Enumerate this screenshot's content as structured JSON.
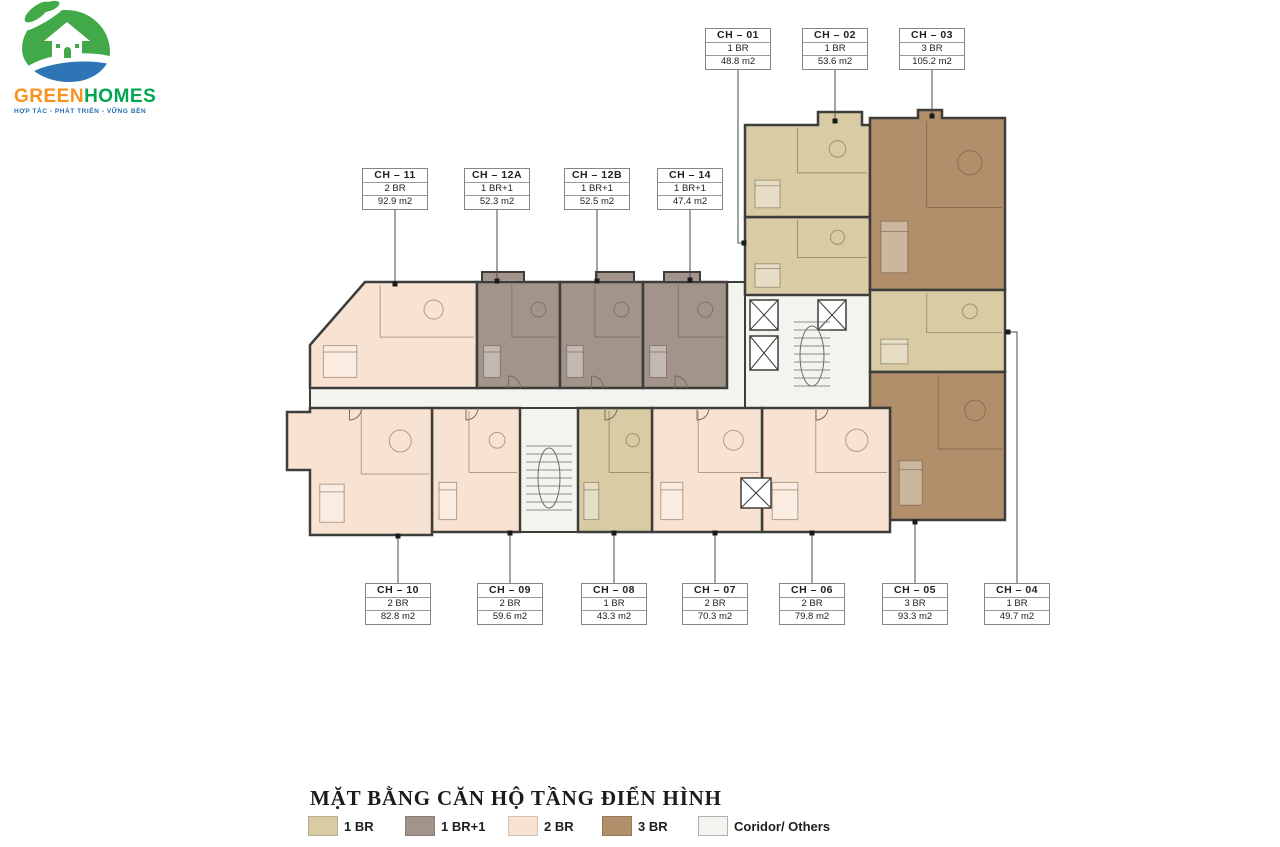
{
  "logo": {
    "name_part1": "GREEN",
    "name_part2": "HOMES",
    "tagline": "HỢP TÁC - PHÁT TRIỂN - VỮNG BỀN",
    "colors": {
      "part1": "#F7941D",
      "part2": "#00A651",
      "tagline": "#1F6CB4",
      "circle": "#42A948",
      "wave": "#2E75B5"
    }
  },
  "title": "MẶT BẰNG CĂN HỘ TẦNG ĐIỂN HÌNH",
  "legend": {
    "items": [
      {
        "label": "1 BR",
        "type": "1br",
        "color": "#D9CCA5"
      },
      {
        "label": "1 BR+1",
        "type": "1br1",
        "color": "#A2948B"
      },
      {
        "label": "2 BR",
        "type": "2br",
        "color": "#F8E2D2"
      },
      {
        "label": "3 BR",
        "type": "3br",
        "color": "#B08F6A"
      },
      {
        "label": "Coridor/ Others",
        "type": "corridor",
        "color": "#F4F4EF"
      }
    ]
  },
  "units": [
    {
      "id": "CH – 01",
      "type": "1br",
      "bedrooms": "1 BR",
      "area": "48.8 m2"
    },
    {
      "id": "CH – 02",
      "type": "1br",
      "bedrooms": "1 BR",
      "area": "53.6 m2"
    },
    {
      "id": "CH – 03",
      "type": "3br",
      "bedrooms": "3 BR",
      "area": "105.2 m2"
    },
    {
      "id": "CH – 04",
      "type": "1br",
      "bedrooms": "1 BR",
      "area": "49.7 m2"
    },
    {
      "id": "CH – 05",
      "type": "3br",
      "bedrooms": "3 BR",
      "area": "93.3 m2"
    },
    {
      "id": "CH – 06",
      "type": "2br",
      "bedrooms": "2 BR",
      "area": "79.8 m2"
    },
    {
      "id": "CH – 07",
      "type": "2br",
      "bedrooms": "2 BR",
      "area": "70.3 m2"
    },
    {
      "id": "CH – 08",
      "type": "1br",
      "bedrooms": "1 BR",
      "area": "43.3 m2"
    },
    {
      "id": "CH – 09",
      "type": "2br",
      "bedrooms": "2 BR",
      "area": "59.6 m2"
    },
    {
      "id": "CH – 10",
      "type": "2br",
      "bedrooms": "2 BR",
      "area": "82.8 m2"
    },
    {
      "id": "CH – 11",
      "type": "2br",
      "bedrooms": "2 BR",
      "area": "92.9 m2"
    },
    {
      "id": "CH – 12A",
      "type": "1br1",
      "bedrooms": "1 BR+1",
      "area": "52.3 m2"
    },
    {
      "id": "CH – 12B",
      "type": "1br1",
      "bedrooms": "1 BR+1",
      "area": "52.5 m2"
    },
    {
      "id": "CH – 14",
      "type": "1br1",
      "bedrooms": "1 BR+1",
      "area": "47.4 m2"
    }
  ]
}
